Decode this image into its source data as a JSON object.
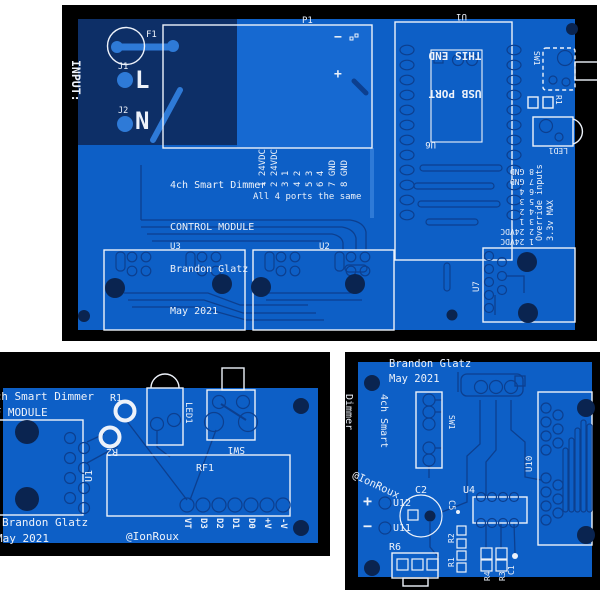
{
  "colors": {
    "pcb_blue": "#0d5fc6",
    "pcb_dark_zone": "#0d2f67",
    "component_fill": "#1669d1",
    "drill_hole": "#0a2450",
    "copper_trace": "#0c3f8f",
    "copper_light": "#2e7ad7",
    "silkscreen": "#edf2fa",
    "background": "#000000"
  },
  "control_board": {
    "input": {
      "line1": "INPUT:",
      "line2": "85-305vac"
    },
    "refs": {
      "f1": "F1",
      "j1": "J1",
      "j2": "J2",
      "l": "L",
      "n": "N",
      "p1": "P1",
      "u1": "U1",
      "u6": "U6",
      "u2": "U2",
      "u3": "U3",
      "u7": "U7",
      "sw1": "SW1",
      "r1": "R1",
      "led1": "LED1"
    },
    "plus": "+",
    "minus": "−",
    "usb_note": {
      "line1": "USB PORT",
      "line2": "THIS END"
    },
    "title": {
      "l1": "4ch Smart Dimmer",
      "l2": "CONTROL MODULE",
      "l3": "Brandon Glatz",
      "l4": "May 2021",
      "l5": "@IonRoux"
    },
    "left_pins": [
      "1 24VDC",
      "2 24VDC",
      "3 1",
      "4 2",
      "5 3",
      "6 4",
      "7 GND",
      "8 GND"
    ],
    "ports_note": "All 4 ports the same",
    "right_pins": [
      "8 GND",
      "7 GND",
      "6 4",
      "5 3",
      "4 2",
      "3 1",
      "2 24VDC",
      "1 24VDC"
    ],
    "override_note": "Override inputs",
    "max_note": "3.3v MAX"
  },
  "rf_board": {
    "title": {
      "l1": "4ch Smart Dimmer",
      "l2": "RF MODULE"
    },
    "credit": {
      "l1": "Brandon Glatz",
      "l2": "May 2021",
      "handle": "@IonRoux"
    },
    "refs": {
      "u1": "U1",
      "r1": "R1",
      "r2": "R2",
      "led1": "LED1",
      "sw1": "SW1",
      "rf1": "RF1"
    },
    "pins": [
      "VT",
      "D3",
      "D2",
      "D1",
      "D0",
      "+V",
      "-V"
    ]
  },
  "output_board": {
    "credit": {
      "l1": "Brandon Glatz",
      "l2": "May 2021",
      "handle": "@IonRoux"
    },
    "title": {
      "l1": "4ch Smart",
      "l2": "Dimmer",
      "l3": "OUTPUT",
      "l4": "MODULE"
    },
    "refs": {
      "sw1": "SW1",
      "u4": "U4",
      "u10": "U10",
      "u11": "U11",
      "u12": "U12",
      "c1": "C1",
      "c2": "C2",
      "c5": "C5",
      "r1": "R1",
      "r2": "R2",
      "r3": "R3",
      "r4": "R4",
      "r6": "R6"
    },
    "plus": "+",
    "minus": "−"
  }
}
